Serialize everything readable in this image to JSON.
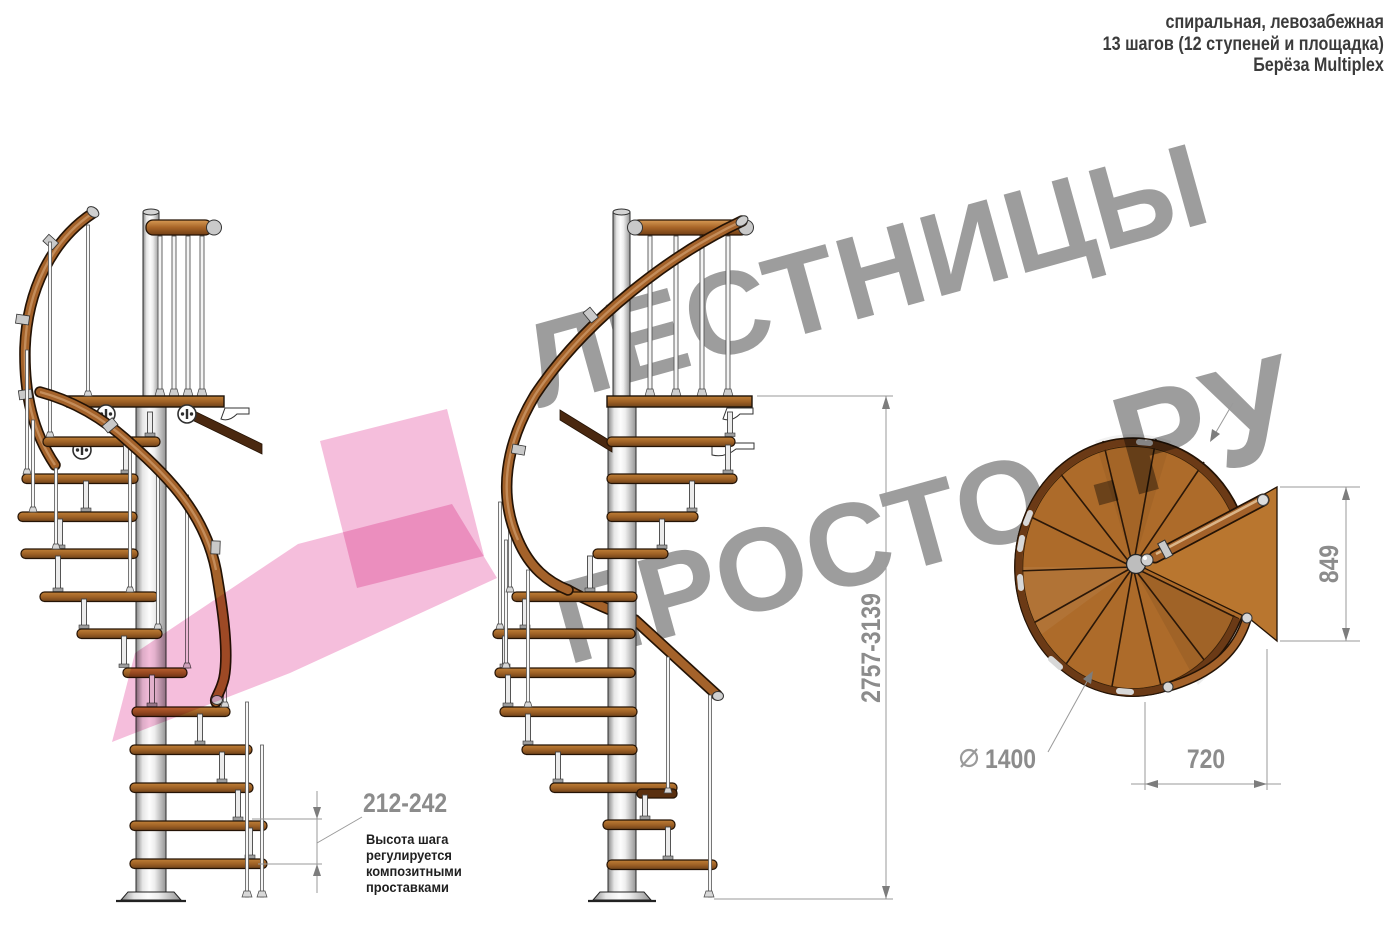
{
  "header": {
    "line1": "спиральная, левозабежная",
    "line2": "13 шагов (12 ступеней и площадка)",
    "line3": "Берёза Multiplex"
  },
  "watermark": {
    "word_top": "ЛЕСТНИЦЫ",
    "word_bottom": "ПРОСТО",
    "suffix": ".РУ"
  },
  "dimensions": {
    "total_height": {
      "value": "2757-3139"
    },
    "step_height": {
      "value": "212-242",
      "note_line1": "Высота шага",
      "note_line2": "регулируется",
      "note_line3": "композитными",
      "note_line4": "проставками"
    },
    "platform_depth": {
      "value": "849"
    },
    "platform_width": {
      "value": "720"
    },
    "diameter": {
      "symbol": "⌀",
      "value": "1400"
    }
  },
  "colors": {
    "watermark_gray": "#9d9d9d",
    "watermark_pink": "#ee8fb6",
    "arrow_pink": "#f5bedc",
    "wood": "#a96a28",
    "wood_dark": "#6e421a",
    "metal_light": "#f2f2f2",
    "dimension_gray": "#8c8c8c",
    "note_dark": "#1f1f1f"
  }
}
